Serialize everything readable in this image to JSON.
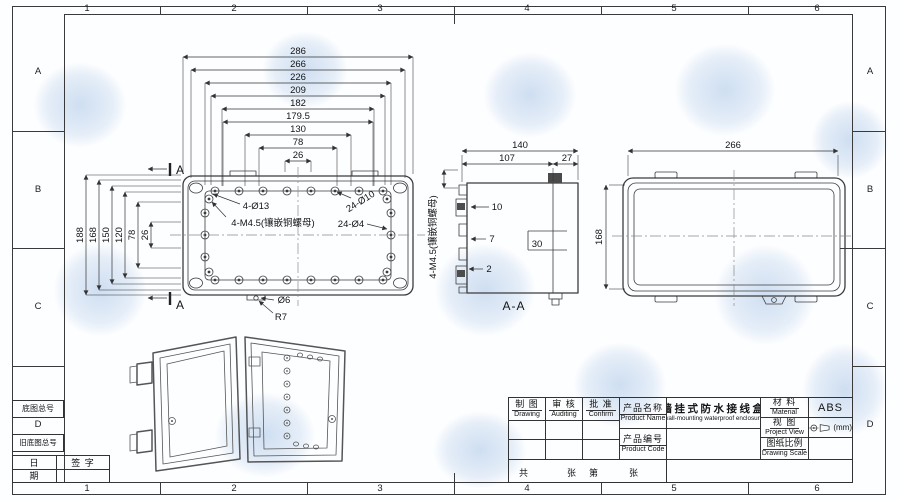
{
  "frame": {
    "zone_cols": [
      "1",
      "2",
      "3",
      "4",
      "5",
      "6"
    ],
    "zone_rows": [
      "A",
      "B",
      "C",
      "D"
    ]
  },
  "left_blocks": {
    "base_drawing_no": "底图总号",
    "old_base_drawing_no": "旧底图总号",
    "date_top": "日",
    "date_bottom": "期",
    "signature": "签 字"
  },
  "front_view": {
    "dims_top": [
      "286",
      "266",
      "226",
      "209",
      "182",
      "179.5",
      "130",
      "78",
      "26"
    ],
    "dims_left": [
      "188",
      "168",
      "150",
      "120",
      "78",
      "26"
    ],
    "note_corner_holes": "4-Ø13",
    "note_inserts": "4-M4.5(镶嵌铜螺母)",
    "note_lid_screws": "24-Ø10",
    "note_small_holes": "24-Ø4",
    "note_hole": "Ø6",
    "note_radius": "R7",
    "section_mark_top": "A",
    "section_mark_bottom": "A"
  },
  "section_view": {
    "dim_overall": "140",
    "dim_body": "107",
    "dim_lid": "27",
    "dim_step1": "10",
    "dim_step2": "7",
    "dim_step3": "2",
    "dim_slot": "30",
    "note_inserts": "4-M4.5(镶嵌铜螺母)",
    "label": "A-A"
  },
  "back_view": {
    "dim_width": "266",
    "dim_height": "168"
  },
  "title_block": {
    "drawing_zh": "制 图",
    "drawing_en": "Drawing",
    "auditing_zh": "审 核",
    "auditing_en": "Auditing",
    "confirm_zh": "批 准",
    "confirm_en": "Confirm",
    "product_name_zh": "产品名称",
    "product_name_en": "Product Name",
    "product_code_zh": "产品编号",
    "product_code_en": "Product Code",
    "product_value_zh": "墙挂式防水接线盒",
    "product_value_en": "wall-mounting waterproof enclosure",
    "material_zh": "材 料",
    "material_en": "Material",
    "material_value": "ABS",
    "view_zh": "视 图",
    "view_en": "Project View",
    "unit": "(mm)",
    "scale_zh": "图纸比例",
    "scale_en": "Drawing Scale",
    "sheet_chars": [
      "共",
      "张",
      "第",
      "张"
    ]
  }
}
